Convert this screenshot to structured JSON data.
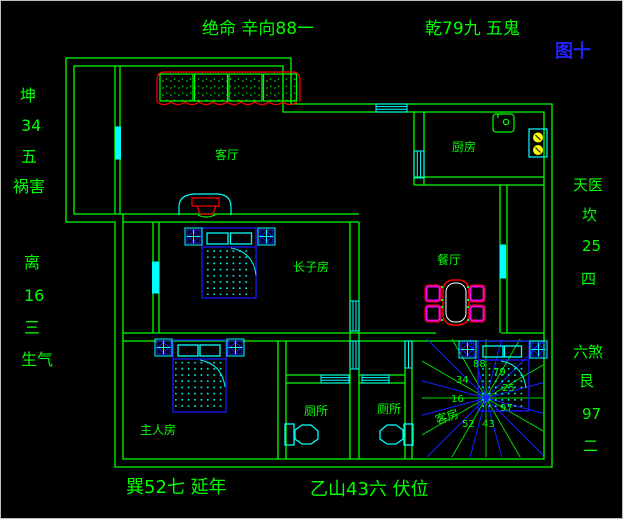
{
  "figure_label": "图十",
  "perimeter": {
    "top_left": "绝命 辛向88一",
    "top_right": "乾79九 五鬼",
    "left_upper": [
      "坤",
      "34",
      "五",
      "祸害"
    ],
    "left_lower": [
      "离",
      "16",
      "三",
      "生气"
    ],
    "right_upper": [
      "天医",
      "坎",
      "25",
      "四"
    ],
    "right_lower": [
      "六煞",
      "艮",
      "97",
      "二"
    ],
    "bottom_left": "巽52七 延年",
    "bottom_right": "乙山43六 伏位"
  },
  "rooms": {
    "living": "客厅",
    "kitchen": "厨房",
    "eldest_son": "长子房",
    "dining": "餐厅",
    "master": "主人房",
    "toilet_left": "厕所",
    "toilet_right": "厕所",
    "guest": "客房"
  },
  "compass": {
    "top": "88",
    "top_right": "79",
    "right": "25",
    "bottom_right": "97",
    "bottom": "43",
    "bottom_left": "52",
    "left": "16",
    "top_left": "34"
  },
  "colors": {
    "wall_green": "#00ff00",
    "window_cyan": "#00ffff",
    "furniture_blue": "#1919ff",
    "accent_red": "#ff0000",
    "chair_magenta": "#ff00ff",
    "burner_yellow": "#ffff00",
    "ray_green": "#00d900",
    "ray_blue": "#1322ff"
  }
}
